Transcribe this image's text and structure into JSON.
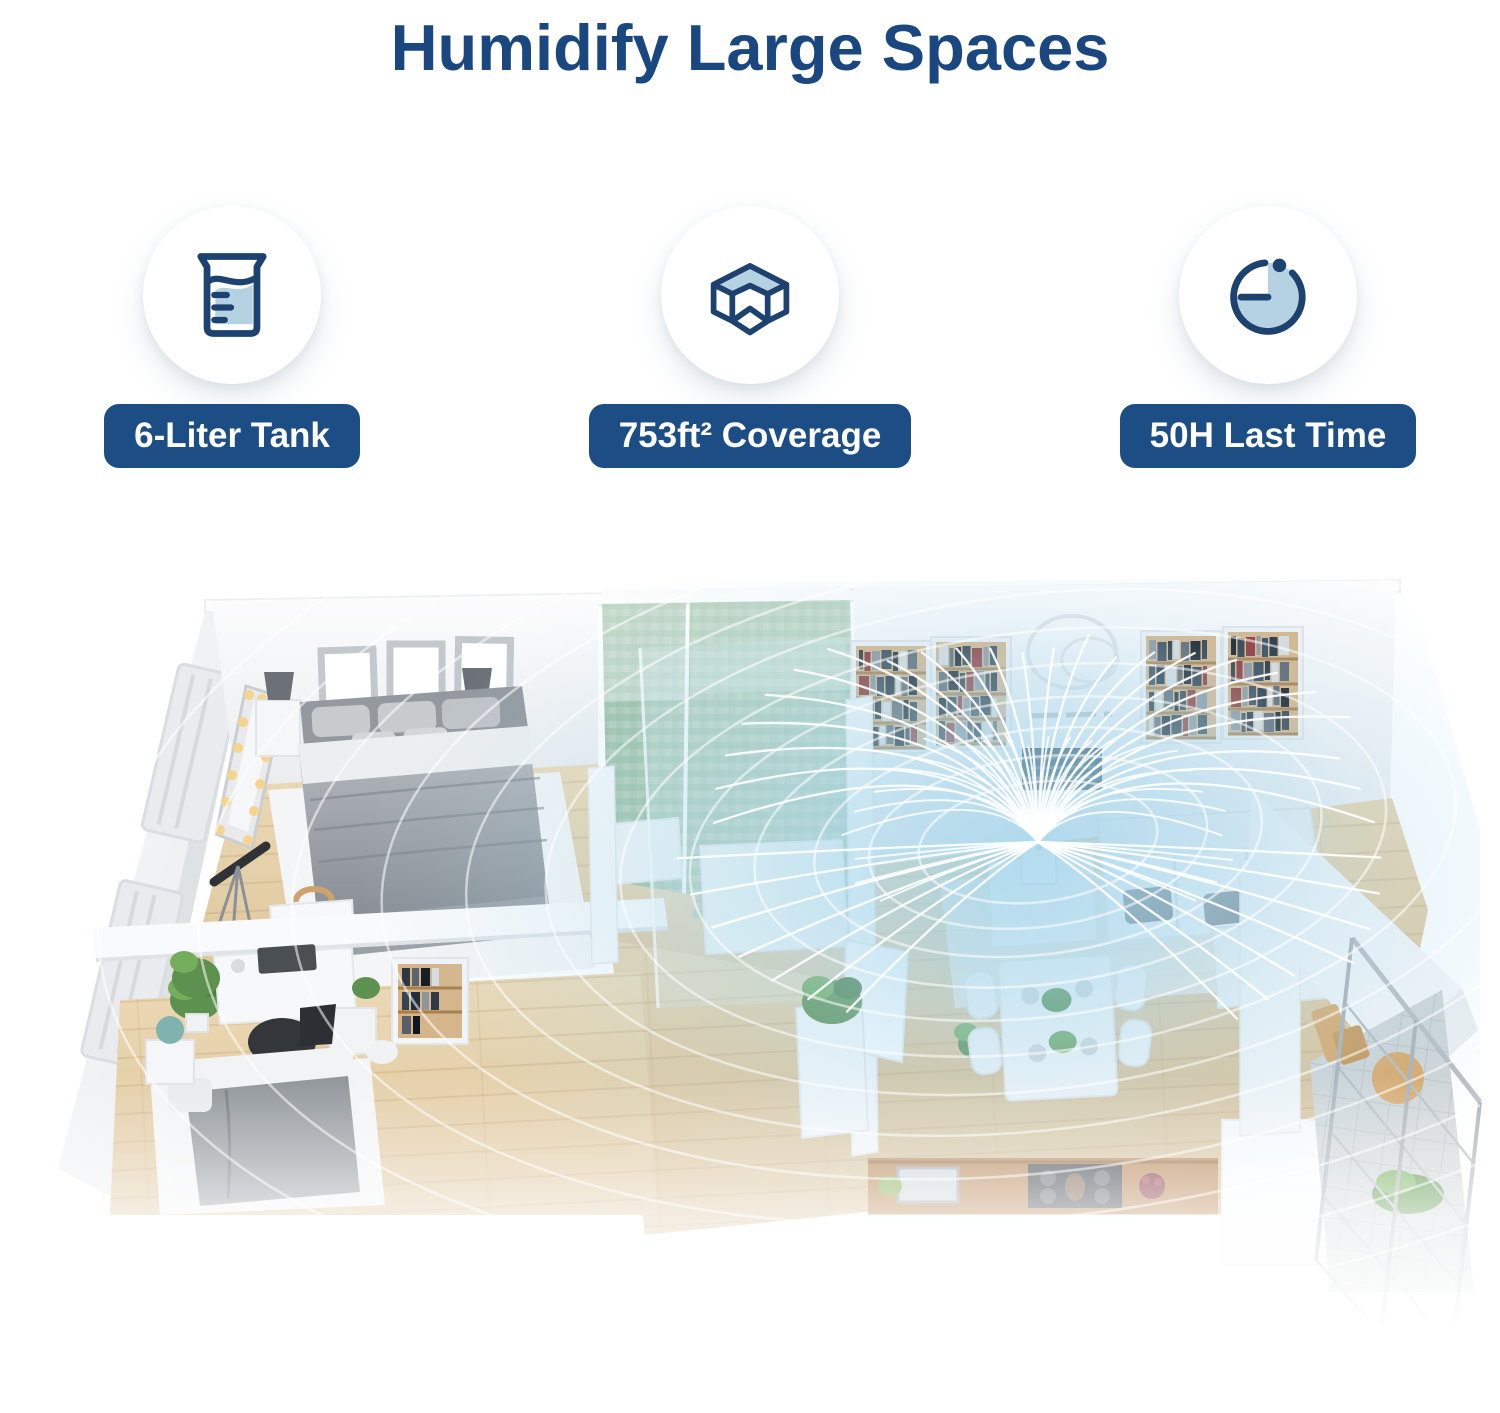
{
  "header": {
    "title": "Humidify Large Spaces"
  },
  "features": [
    {
      "icon": "water-tank-icon",
      "label": "6-Liter Tank"
    },
    {
      "icon": "room-coverage-icon",
      "label": "753ft² Coverage"
    },
    {
      "icon": "timer-icon",
      "label": "50H Last Time"
    }
  ],
  "colors": {
    "title_blue": "#1a4780",
    "badge_blue": "#1c4d85",
    "icon_navy": "#1d4270",
    "icon_light_blue": "#b5d2e2",
    "mist_blue": "#9ed3eb",
    "wood_floor": "#e3cda6",
    "counter_wood": "#b5793f",
    "mosaic_green": "#a9c7ae"
  }
}
